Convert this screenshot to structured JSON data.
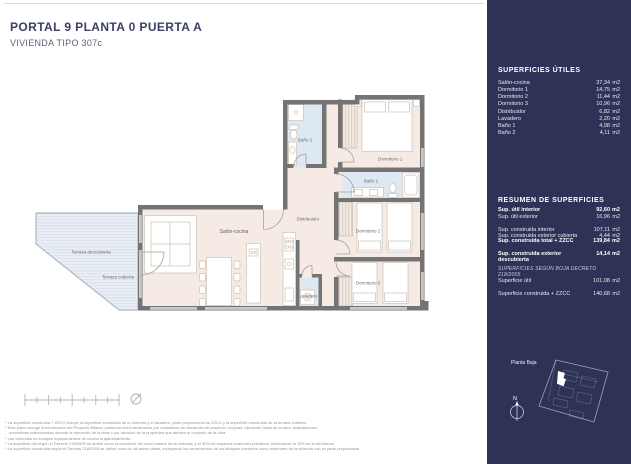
{
  "header": {
    "title": "PORTAL 9  PLANTA 0 PUERTA A",
    "subtitle": "VIVIENDA TIPO 307c"
  },
  "plan": {
    "rooms": {
      "salon_cocina": "Salón-cocina",
      "distribuidor": "Distribuidor",
      "dormitorio_1": "Dormitorio 1",
      "dormitorio_2": "Dormitorio 2",
      "dormitorio_3": "Dormitorio 3",
      "bano_1": "Baño 1",
      "bano_2": "Baño 2",
      "lavadero": "Lavadero",
      "terraza_descubierta": "Terraza descubierta",
      "terraza_cubierta": "Terraza cubierta"
    }
  },
  "sidebar": {
    "superficies_utiles": {
      "title": "SUPERFICIES ÚTILES",
      "rows": [
        {
          "label": "Salón-cocina",
          "value": "37,34",
          "unit": "m2"
        },
        {
          "label": "Dormitorio 1",
          "value": "14,75",
          "unit": "m2"
        },
        {
          "label": "Dormitorio 2",
          "value": "11,44",
          "unit": "m2"
        },
        {
          "label": "Dormitorio 3",
          "value": "10,96",
          "unit": "m2"
        },
        {
          "label": "Distribuidor",
          "value": "6,82",
          "unit": "m2"
        },
        {
          "label": "Lavadero",
          "value": "2,20",
          "unit": "m2"
        },
        {
          "label": "Baño 1",
          "value": "4,98",
          "unit": "m2"
        },
        {
          "label": "Baño 2",
          "value": "4,11",
          "unit": "m2"
        }
      ]
    },
    "resumen": {
      "title": "RESUMEN DE SUPERFICIES",
      "rows": [
        {
          "label": "Sup. útil interior",
          "value": "92,60",
          "unit": "m2"
        },
        {
          "label": "Sup. útil exterior",
          "value": "16,96",
          "unit": "m2"
        },
        {
          "label": "Sup. construida interior",
          "value": "107,11",
          "unit": "m2"
        },
        {
          "label": "Sup. construida exterior cubierta",
          "value": "4,44",
          "unit": "m2"
        },
        {
          "label": "Sup. construida total + ZZCC",
          "value": "139,84",
          "unit": "m2"
        },
        {
          "label": "Sup. construida exterior descubierta",
          "value": "14,14",
          "unit": "m2"
        }
      ]
    },
    "boja": {
      "title": "SUPERFICIES SEGÚN BOJA DECRETO 218/2005",
      "rows": [
        {
          "label": "Superficie útil",
          "value": "101,08",
          "unit": "m2"
        },
        {
          "label": "Superficie construida + ZZCC",
          "value": "140,68",
          "unit": "m2"
        }
      ]
    },
    "minimap_label": "Planta Baja",
    "north_label": "N"
  },
  "footer": {
    "disclaimers": [
      "* La superficie construida + ZZCC incluye la superficie construida de la vivienda y el lavadero, parte proporcional de ZZCC y la superficie construida de la terraza cubierta.",
      "* Este plano recoge la información del Proyecto Básico, pudiendo sufrir variaciones por cuestiones de desarrollo de proyecto, mejoras, ejecución física de la obra, disposiciones",
      "normativas sobrevenidas durante la ejecución de la obra o por decisión de la propiedad que afecten al conjunto de la obra.",
      "* Las viviendas no incluyen equipamientos de cocina ni ajardinamiento.",
      "* La superficie útil según el Decreto 218/2005 se define como la superficie del suelo interior de la vivienda, y el 50% de espacios exteriores privativos, limitándose al 10% de la útil interior.",
      "* La superficie construida según el Decreto 218/2005 se define como la útil antes citada, incluyendo los cerramientos de los tabiques interiores como exteriores de la vivienda con su parte proporcional."
    ]
  },
  "colors": {
    "sidebar_bg": "#2f3257",
    "title_text": "#3b4066",
    "wall": "#747474",
    "floor": "#f6ebe4",
    "wet_room": "#dde8f2",
    "terrace": "#eaeff6"
  }
}
